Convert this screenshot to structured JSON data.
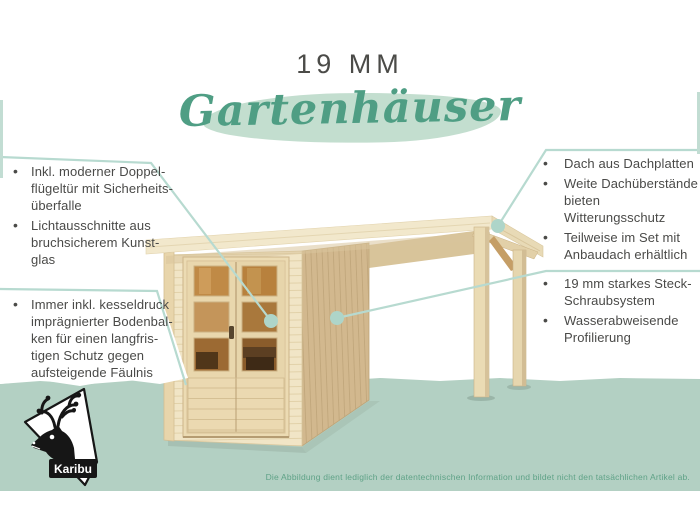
{
  "header": {
    "size_label": "19 MM",
    "title": "Gartenhäuser"
  },
  "callouts": {
    "left_top": {
      "items": [
        "Inkl. moderner Doppel-\nflügeltür mit Sicherheits-\nüberfalle",
        "Lichtausschnitte aus\nbruchsicherem Kunst-\nglas"
      ]
    },
    "left_bottom": {
      "items": [
        "Immer inkl. kesseldruck\nimprägnierter Bodenbal-\nken für einen langfris-\ntigen Schutz gegen\naufsteigende Fäulnis"
      ]
    },
    "right_top": {
      "items": [
        "Dach aus Dachplatten",
        "Weite Dachüberstände\nbieten Witterungsschutz",
        "Teilweise im Set mit\nAnbaudach erhältlich"
      ]
    },
    "right_bottom": {
      "items": [
        "19 mm starkes Steck-\nSchraubsystem",
        "Wasserabweisende\nProfilierung"
      ]
    }
  },
  "footer": {
    "disclaimer": "Die Abbildung dient lediglich der datentechnischen Information und bildet nicht den tatsächlichen Artikel ab."
  },
  "logo": {
    "brand": "Karibu"
  },
  "colors": {
    "accent_green": "#4f9e84",
    "band_green": "#b3d0c3",
    "leader_teal": "#b7dad0",
    "text_dark": "#4b4b48",
    "disclaimer_green": "#5fa287",
    "wood_light": "#f1e5c6",
    "wood_side": "#d2b88e",
    "glass_amber": "#c08a46"
  },
  "illustration": {
    "subject": "Flat-roof wooden garden house with glazed double door and side canopy on two posts"
  }
}
